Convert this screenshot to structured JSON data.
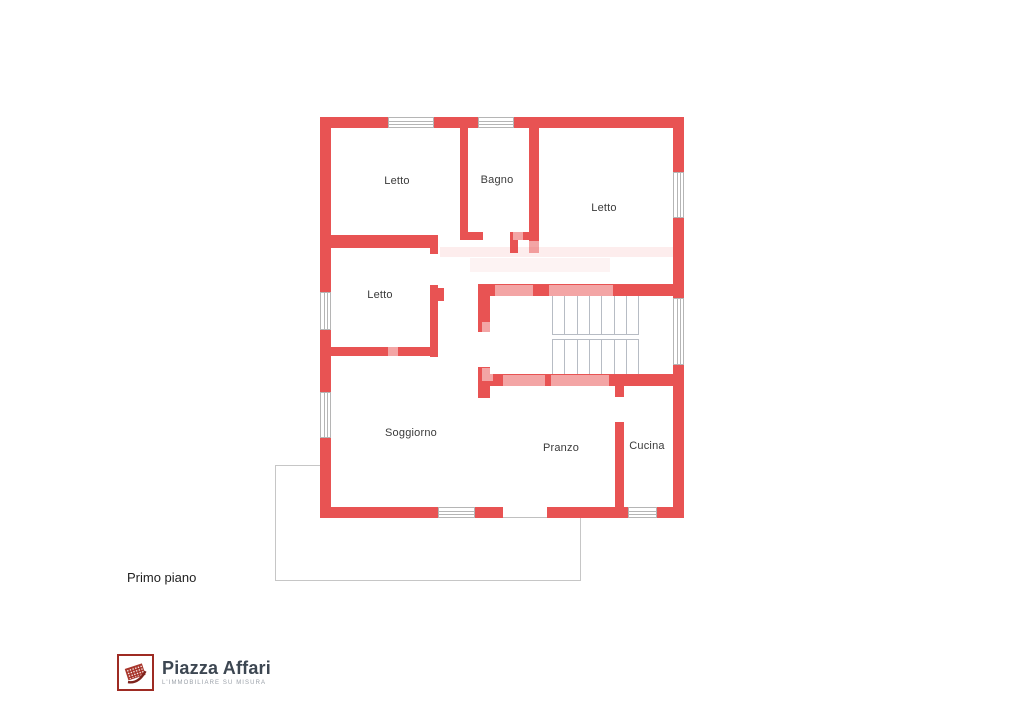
{
  "plan": {
    "rooms": [
      {
        "id": "letto-1",
        "label": "Letto",
        "x": 397,
        "y": 181
      },
      {
        "id": "bagno",
        "label": "Bagno",
        "x": 497,
        "y": 180
      },
      {
        "id": "letto-2",
        "label": "Letto",
        "x": 604,
        "y": 208
      },
      {
        "id": "letto-3",
        "label": "Letto",
        "x": 380,
        "y": 295
      },
      {
        "id": "soggiorno",
        "label": "Soggiorno",
        "x": 411,
        "y": 433
      },
      {
        "id": "pranzo",
        "label": "Pranzo",
        "x": 561,
        "y": 448
      },
      {
        "id": "cucina",
        "label": "Cucina",
        "x": 647,
        "y": 446
      }
    ],
    "floor_label": "Primo piano"
  },
  "logo": {
    "name": "Piazza Affari",
    "tagline": "L'IMMOBILIARE SU MISURA"
  },
  "colors": {
    "wall-red": "#e85353",
    "window-line": "#b5b5b5",
    "stair-line": "#b7bcc4",
    "terrace-line": "#c6c6c6",
    "logo-red": "#9e2b23",
    "logo-text": "#3d4752"
  }
}
